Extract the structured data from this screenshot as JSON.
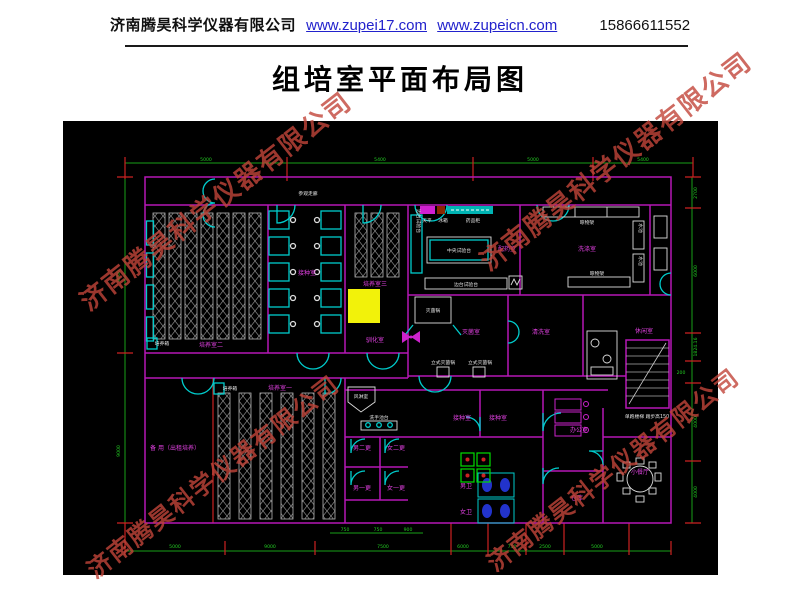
{
  "header": {
    "company": "济南腾昊科学仪器有限公司",
    "link1": "www.zupei17.com",
    "link2": "www.zupeicn.com",
    "phone": "15866611552"
  },
  "title": "组培室平面布局图",
  "watermark": {
    "text": "济南腾昊科学仪器有限公司",
    "color": "#c2453a"
  },
  "colors": {
    "background": "#000000",
    "walls_magenta": "#b617b6",
    "fixtures_cyan": "#00cccc",
    "dims_green": "#22cc22",
    "ticks_red": "#cc2222",
    "room_text_magenta": "#e040e0",
    "equip_text_white": "#e2e2e2",
    "highlight_yellow": "#f2f20a",
    "link_blue": "#2222cc",
    "toilet_blue": "#2233cc",
    "equip_green": "#00dd00"
  },
  "plan": {
    "labels": [
      {
        "t": "参观走廊",
        "x": 245,
        "y": 74,
        "c": "eq",
        "s": 5.5,
        "n": "label-viewing-corridor"
      },
      {
        "t": "培养室二",
        "x": 148,
        "y": 226,
        "c": "rm",
        "n": "label-culture-room-2"
      },
      {
        "t": "接种室",
        "x": 244,
        "y": 154,
        "c": "rm",
        "n": "label-inoculation-room"
      },
      {
        "t": "培养室三",
        "x": 312,
        "y": 165,
        "c": "rm",
        "n": "label-culture-room-3"
      },
      {
        "t": "驯化室",
        "x": 312,
        "y": 221,
        "c": "rm",
        "n": "label-acclimation-room"
      },
      {
        "t": "培养室一",
        "x": 217,
        "y": 269,
        "c": "rm",
        "n": "label-culture-room-1"
      },
      {
        "t": "备 用（出租培养）",
        "x": 112,
        "y": 329,
        "c": "rm",
        "n": "label-spare-room"
      },
      {
        "t": "配药室",
        "x": 444,
        "y": 130,
        "c": "rm",
        "n": "label-media-prep-room"
      },
      {
        "t": "洗涤室",
        "x": 524,
        "y": 130,
        "c": "rm",
        "n": "label-washing-room"
      },
      {
        "t": "灭菌室",
        "x": 408,
        "y": 213,
        "c": "rm",
        "n": "label-sterilization-room"
      },
      {
        "t": "清洗室",
        "x": 478,
        "y": 213,
        "c": "rm",
        "n": "label-rinse-room"
      },
      {
        "t": "休闲室",
        "x": 581,
        "y": 212,
        "c": "rm",
        "n": "label-lounge"
      },
      {
        "t": "男二更",
        "x": 299,
        "y": 329,
        "c": "rm",
        "n": "label-men-change-2"
      },
      {
        "t": "女二更",
        "x": 333,
        "y": 329,
        "c": "rm",
        "n": "label-women-change-2"
      },
      {
        "t": "男一更",
        "x": 299,
        "y": 369,
        "c": "rm",
        "n": "label-men-change-1"
      },
      {
        "t": "女一更",
        "x": 333,
        "y": 369,
        "c": "rm",
        "n": "label-women-change-1"
      },
      {
        "t": "接种室",
        "x": 399,
        "y": 299,
        "c": "rm",
        "n": "label-inoculation-room-a"
      },
      {
        "t": "接种室",
        "x": 435,
        "y": 299,
        "c": "rm",
        "n": "label-inoculation-room-b"
      },
      {
        "t": "男卫",
        "x": 403,
        "y": 367,
        "c": "rm",
        "n": "label-men-toilet"
      },
      {
        "t": "女卫",
        "x": 403,
        "y": 393,
        "c": "rm",
        "n": "label-women-toilet"
      },
      {
        "t": "办公室",
        "x": 516,
        "y": 311,
        "c": "rm",
        "n": "label-office"
      },
      {
        "t": "仓库",
        "x": 514,
        "y": 379,
        "c": "rm",
        "n": "label-storage"
      },
      {
        "t": "小餐厅",
        "x": 577,
        "y": 353,
        "c": "rm",
        "n": "label-dining-room"
      },
      {
        "t": "培养箱",
        "x": 99,
        "y": 224,
        "c": "eq",
        "s": 4.4
      },
      {
        "t": "培养箱",
        "x": 167,
        "y": 269,
        "c": "eq",
        "s": 4.4
      },
      {
        "t": "天平",
        "x": 364,
        "y": 101,
        "c": "eq",
        "s": 4.2
      },
      {
        "t": "冰箱",
        "x": 380,
        "y": 101,
        "c": "eq",
        "s": 4.2
      },
      {
        "t": "药品柜",
        "x": 410,
        "y": 101,
        "c": "eq",
        "s": 4.2
      },
      {
        "t": "中央试验台",
        "x": 396,
        "y": 131,
        "c": "eq"
      },
      {
        "t": "边台试验台",
        "x": 403,
        "y": 165,
        "c": "eq",
        "s": 4.4
      },
      {
        "t": "边台试验台",
        "x": 354,
        "y": 100,
        "c": "eq",
        "s": 4,
        "r": 90
      },
      {
        "t": "灭菌锅",
        "x": 370,
        "y": 191,
        "c": "eq"
      },
      {
        "t": "立式灭菌锅",
        "x": 380,
        "y": 243,
        "c": "eq",
        "s": 4.4
      },
      {
        "t": "立式灭菌锅",
        "x": 417,
        "y": 243,
        "c": "eq",
        "s": 4.4
      },
      {
        "t": "风淋室",
        "x": 298,
        "y": 277,
        "c": "eq",
        "s": 4.4
      },
      {
        "t": "洗手池台",
        "x": 316,
        "y": 298,
        "c": "eq",
        "s": 4.2
      },
      {
        "t": "晾物架",
        "x": 524,
        "y": 103,
        "c": "eq",
        "s": 4.4
      },
      {
        "t": "晾物架",
        "x": 534,
        "y": 154,
        "c": "eq",
        "s": 4.4
      },
      {
        "t": "水池",
        "x": 576,
        "y": 107,
        "c": "eq",
        "s": 4,
        "r": 90
      },
      {
        "t": "水池",
        "x": 576,
        "y": 140,
        "c": "eq",
        "s": 4,
        "r": 90
      },
      {
        "t": "单跑楼梯 踏步高150",
        "x": 584,
        "y": 297,
        "c": "eq",
        "s": 4
      },
      {
        "t": "5000",
        "x": 143,
        "y": 40,
        "c": "dm"
      },
      {
        "t": "5400",
        "x": 317,
        "y": 40,
        "c": "dm"
      },
      {
        "t": "5000",
        "x": 470,
        "y": 40,
        "c": "dm"
      },
      {
        "t": "5400",
        "x": 580,
        "y": 40,
        "c": "dm"
      },
      {
        "t": "9000",
        "x": 57,
        "y": 155,
        "c": "dm",
        "r": -90
      },
      {
        "t": "9000",
        "x": 57,
        "y": 330,
        "c": "dm",
        "r": -90
      },
      {
        "t": "2700",
        "x": 634,
        "y": 72,
        "c": "dm",
        "r": -90
      },
      {
        "t": "6000",
        "x": 634,
        "y": 150,
        "c": "dm",
        "r": -90
      },
      {
        "t": "1824.16",
        "x": 634,
        "y": 226,
        "c": "dm",
        "r": -90
      },
      {
        "t": "200",
        "x": 618,
        "y": 253,
        "c": "dm"
      },
      {
        "t": "4000",
        "x": 634,
        "y": 301,
        "c": "dm",
        "r": -90
      },
      {
        "t": "4000",
        "x": 634,
        "y": 371,
        "c": "dm",
        "r": -90
      },
      {
        "t": "5000",
        "x": 112,
        "y": 427,
        "c": "dm"
      },
      {
        "t": "9000",
        "x": 207,
        "y": 427,
        "c": "dm"
      },
      {
        "t": "7500",
        "x": 320,
        "y": 427,
        "c": "dm"
      },
      {
        "t": "6000",
        "x": 400,
        "y": 427,
        "c": "dm"
      },
      {
        "t": "750",
        "x": 449,
        "y": 427,
        "c": "dm"
      },
      {
        "t": "2500",
        "x": 482,
        "y": 427,
        "c": "dm"
      },
      {
        "t": "5000",
        "x": 534,
        "y": 427,
        "c": "dm"
      },
      {
        "t": "750",
        "x": 282,
        "y": 410,
        "c": "dm"
      },
      {
        "t": "750",
        "x": 315,
        "y": 410,
        "c": "dm"
      },
      {
        "t": "900",
        "x": 345,
        "y": 410,
        "c": "dm"
      }
    ]
  }
}
